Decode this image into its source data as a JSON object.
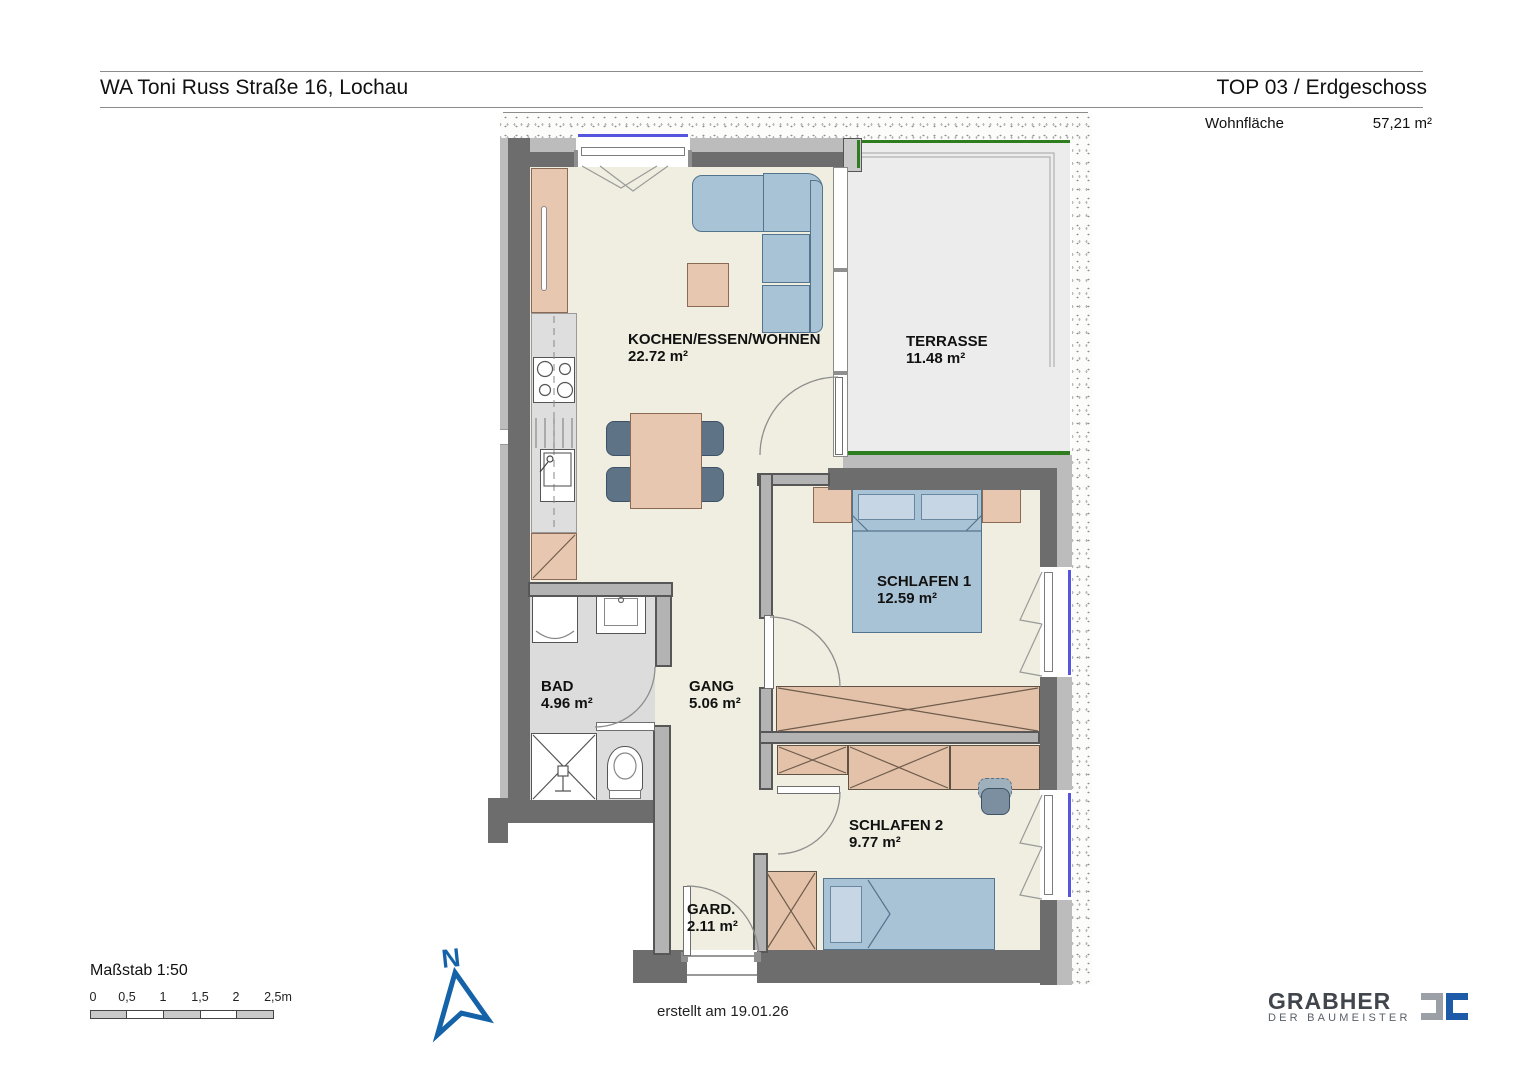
{
  "header": {
    "project_title": "WA Toni Russ Straße 16, Lochau",
    "unit_title": "TOP 03 / Erdgeschoss",
    "living_area_label": "Wohnfläche",
    "living_area_value": "57,21 m²"
  },
  "rooms": [
    {
      "name": "KOCHEN/ESSEN/WOHNEN",
      "area": "22.72 m²"
    },
    {
      "name": "TERRASSE",
      "area": "11.48 m²"
    },
    {
      "name": "SCHLAFEN 1",
      "area": "12.59 m²"
    },
    {
      "name": "BAD",
      "area": "4.96 m²"
    },
    {
      "name": "GANG",
      "area": "5.06 m²"
    },
    {
      "name": "SCHLAFEN 2",
      "area": "9.77 m²"
    },
    {
      "name": "GARD.",
      "area": "2.11 m²"
    }
  ],
  "scale_bar": {
    "label": "Maßstab 1:50",
    "ticks": [
      "0",
      "0,5",
      "1",
      "1,5",
      "2",
      "2,5m"
    ]
  },
  "north_arrow": {
    "label": "N"
  },
  "footer": {
    "created_text": "erstellt am 19.01.26"
  },
  "logo": {
    "name": "GRABHER",
    "tagline": "DER BAUMEISTER"
  },
  "colors": {
    "accent_blue": "#1463a8",
    "logo_gray": "#9aa0a6",
    "logo_blue": "#1d5ba8",
    "wall_dark": "#6d6d6d",
    "floor_cream": "#efeee0",
    "bath_floor": "#dcdcdc",
    "terrace_floor": "#ececec",
    "furniture_tan": "#e7c7af",
    "furniture_blue": "#a9c3d6",
    "terrace_green": "#2e7d1e",
    "window_blue": "#5555e0"
  }
}
